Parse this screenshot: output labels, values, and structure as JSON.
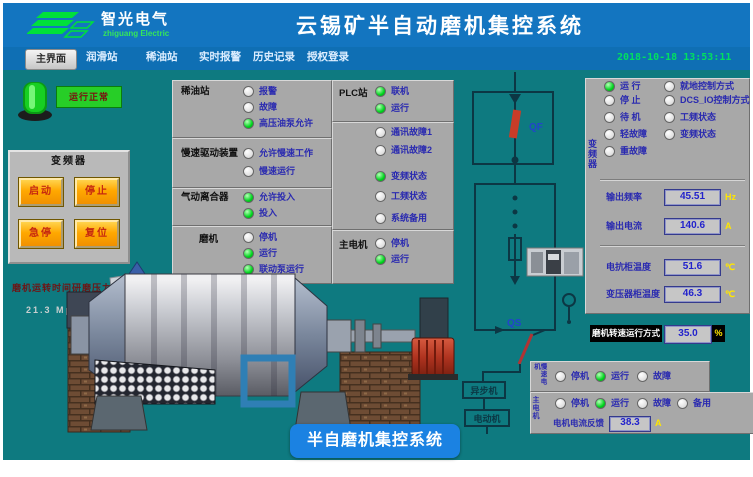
{
  "header": {
    "brand": "智光电气",
    "brand_sub": "zhiguang Electric",
    "title": "云锡矿半自动磨机集控系统"
  },
  "menu": {
    "active_tab": "主界面",
    "tabs": [
      "润滑站",
      "稀油站",
      "实时报警",
      "历史记录",
      "授权登录"
    ],
    "datetime": "2018-10-18 13:53:11"
  },
  "left_panel": {
    "run_lamp_label": "运行正常",
    "vfd": {
      "title": "变频器",
      "buttons": [
        "启动",
        "停止",
        "急停",
        "复位"
      ]
    },
    "pressure_caption": "磨机运转时间研磨压力",
    "pressure_value": "21.3 Mpa"
  },
  "status_columns": {
    "col1": [
      {
        "title": "稀油站",
        "items": [
          {
            "state": "off",
            "label": "报警"
          },
          {
            "state": "off",
            "label": "故障"
          },
          {
            "state": "on",
            "label": "高压油泵允许"
          }
        ]
      },
      {
        "title": "慢速驱动装置",
        "items": [
          {
            "state": "off",
            "label": "允许慢速工作"
          },
          {
            "state": "off",
            "label": "慢速运行"
          }
        ]
      },
      {
        "title": "气动离合器",
        "items": [
          {
            "state": "on",
            "label": "允许投入"
          },
          {
            "state": "on",
            "label": "投入"
          }
        ]
      },
      {
        "title": "磨机",
        "items": [
          {
            "state": "off",
            "label": "停机"
          },
          {
            "state": "on",
            "label": "运行"
          },
          {
            "state": "on",
            "label": "联动泵运行"
          }
        ]
      }
    ],
    "col2": [
      {
        "title": "PLC站",
        "items": [
          {
            "state": "on",
            "label": "联机"
          },
          {
            "state": "on",
            "label": "运行"
          }
        ]
      },
      {
        "title": "",
        "items": [
          {
            "state": "off",
            "label": "通讯故障1"
          },
          {
            "state": "off",
            "label": "通讯故障2"
          },
          {
            "state": "on",
            "label": "变频状态"
          },
          {
            "state": "off",
            "label": "工频状态"
          },
          {
            "state": "off",
            "label": "系统备用"
          }
        ]
      },
      {
        "title": "主电机",
        "items": [
          {
            "state": "off",
            "label": "停机"
          },
          {
            "state": "on",
            "label": "运行"
          }
        ]
      }
    ]
  },
  "diagram": {
    "breaker_label": "QF",
    "switch_label": "QS",
    "motor_box1": "异步机",
    "motor_box2": "电动机"
  },
  "vfd_status_panel": {
    "vertical_label": "变频器",
    "left_items": [
      {
        "state": "on",
        "label": "运 行"
      },
      {
        "state": "off",
        "label": "停 止"
      },
      {
        "state": "off",
        "label": "待 机"
      },
      {
        "state": "off",
        "label": "轻故障"
      },
      {
        "state": "off",
        "label": "重故障"
      }
    ],
    "right_items": [
      {
        "state": "off",
        "label": "就地控制方式"
      },
      {
        "state": "off",
        "label": "DCS_IO控制方式"
      },
      {
        "state": "off",
        "label": "工频状态"
      },
      {
        "state": "off",
        "label": "变频状态"
      }
    ],
    "readouts": [
      {
        "label": "输出频率",
        "value": "45.51",
        "unit": "Hz"
      },
      {
        "label": "输出电流",
        "value": "140.6",
        "unit": "A"
      },
      {
        "label": "电抗柜温度",
        "value": "51.6",
        "unit": "℃"
      },
      {
        "label": "变压器柜温度",
        "value": "46.3",
        "unit": "℃"
      }
    ]
  },
  "speed_setting": {
    "label": "磨机转速运行方式",
    "value": "35.0",
    "unit": "%"
  },
  "bottom_panels": [
    {
      "vertical_label": "慢速电机",
      "items": [
        {
          "state": "off",
          "label": "停机"
        },
        {
          "state": "on",
          "label": "运行"
        },
        {
          "state": "off",
          "label": "故障"
        }
      ]
    },
    {
      "vertical_label": "主电机",
      "items": [
        {
          "state": "off",
          "label": "停机"
        },
        {
          "state": "on",
          "label": "运行"
        },
        {
          "state": "off",
          "label": "故障"
        },
        {
          "state": "off",
          "label": "备用"
        }
      ],
      "readout": {
        "label": "电机电流反馈",
        "value": "38.3",
        "unit": "A"
      }
    }
  ],
  "footer_tag": "半自磨机集控系统",
  "colors": {
    "teal_bg": "#0e7a80",
    "header_blue": "#1375c0",
    "led_on": "#00d41e",
    "accent_orange": "#ffa800",
    "text_blue": "#2a2ab0",
    "value_yellow": "#ffe600",
    "datetime_green": "#00e060",
    "tag_blue": "#1b82e2"
  }
}
